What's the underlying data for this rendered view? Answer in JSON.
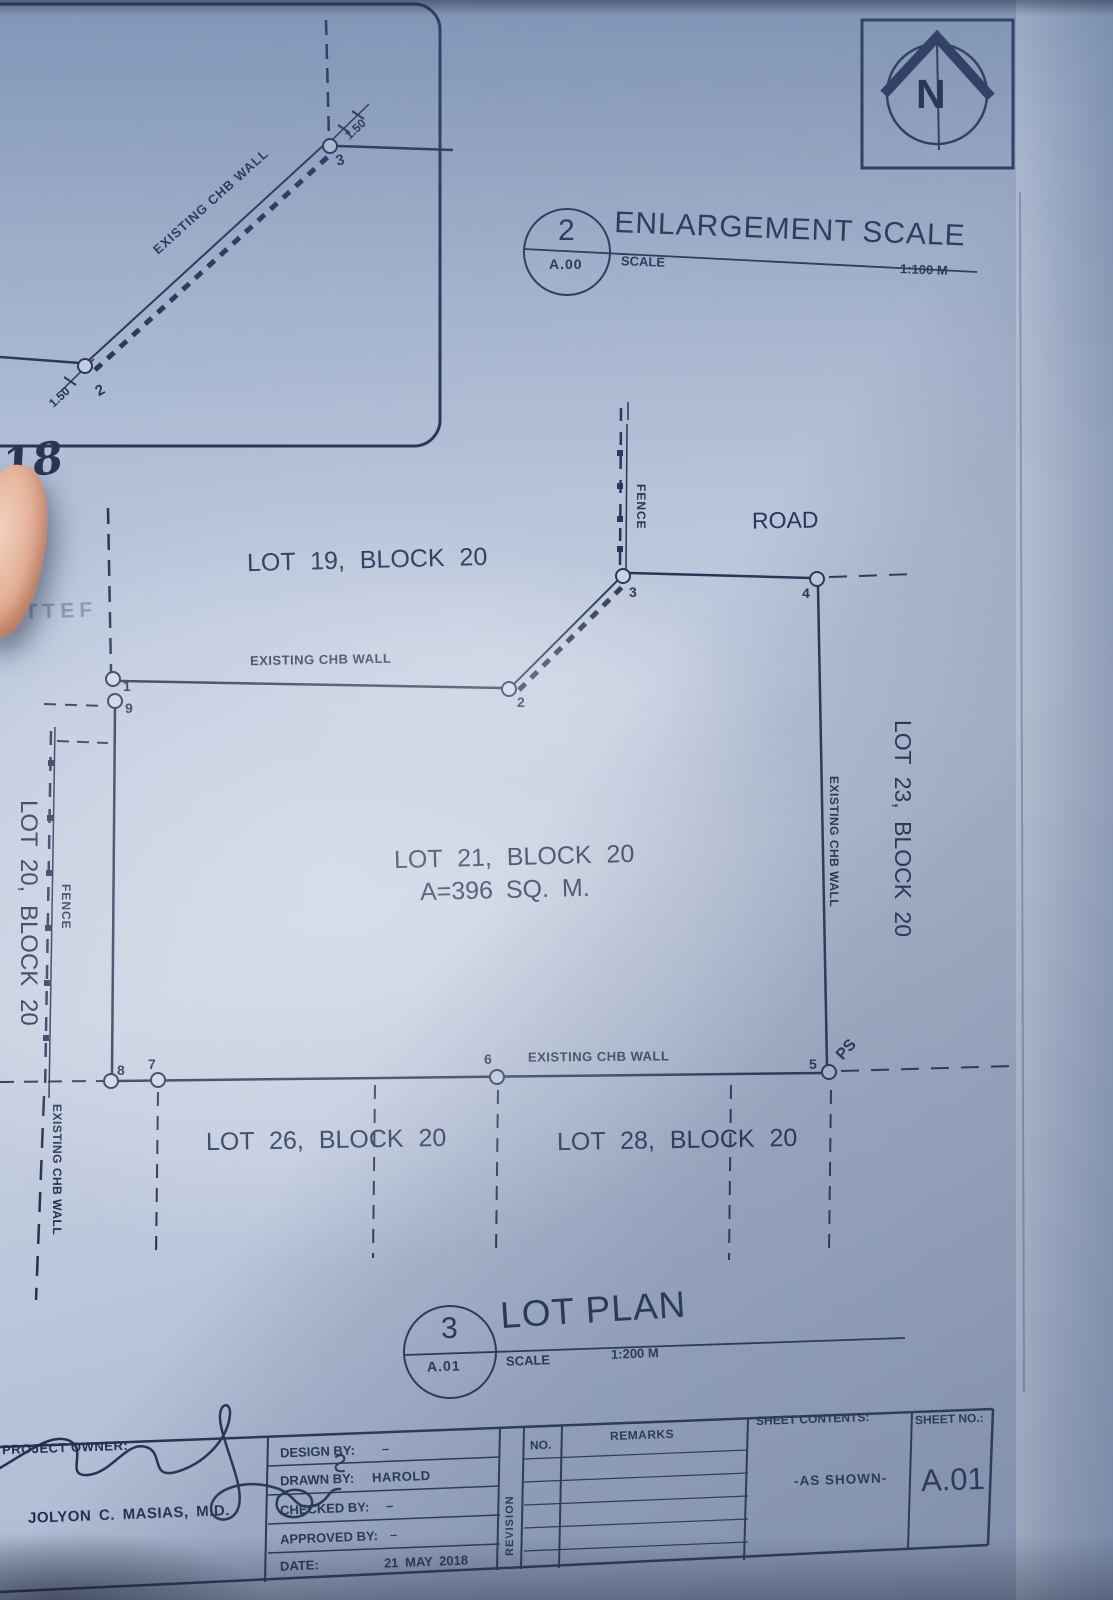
{
  "colors": {
    "paper": "#b7c3d8",
    "ink": "#243253"
  },
  "north_arrow": {
    "letter": "N"
  },
  "enlargement_view": {
    "bubble_number": "2",
    "bubble_sheet": "A.00",
    "title": "ENLARGEMENT SCALE",
    "scale_label": "SCALE",
    "scale_value": "1:100 M",
    "wall_label": "EXISTING CHB WALL",
    "dim_top": "1.50",
    "dim_bottom": "1.50",
    "point_top": "3",
    "point_bottom": "2"
  },
  "annotations": {
    "handwritten_number": "18",
    "faint_stamp": "ATTEF"
  },
  "plan": {
    "road_label": "ROAD",
    "fence_top": "FENCE",
    "fence_left": "FENCE",
    "wall_top": "EXISTING CHB WALL",
    "wall_right": "EXISTING CHB WALL",
    "wall_bottom": "EXISTING CHB WALL",
    "wall_left": "EXISTING CHB WALL",
    "ps_label": "PS",
    "lot19": "LOT 19, BLOCK 20",
    "lot20": "LOT 20, BLOCK 20",
    "lot21_name": "LOT 21, BLOCK 20",
    "lot21_area": "A=396 SQ. M.",
    "lot23": "LOT 23, BLOCK 20",
    "lot26": "LOT 26, BLOCK 20",
    "lot28": "LOT 28, BLOCK 20",
    "points": {
      "p1": "1",
      "p2": "2",
      "p3": "3",
      "p4": "4",
      "p5": "5",
      "p6": "6",
      "p7": "7",
      "p8": "8",
      "p9": "9"
    }
  },
  "lot_plan_view": {
    "bubble_number": "3",
    "bubble_sheet": "A.01",
    "title": "LOT PLAN",
    "scale_label": "SCALE",
    "scale_value": "1:200 M"
  },
  "title_block": {
    "project_owner_label": "PROJECT OWNER:",
    "project_owner_name": "JOLYON C. MASIAS, M.D.",
    "rows": [
      {
        "label": "DESIGN BY:",
        "value": "–"
      },
      {
        "label": "DRAWN BY:",
        "value": "HAROLD"
      },
      {
        "label": "CHECKED BY:",
        "value": "–"
      },
      {
        "label": "APPROVED BY:",
        "value": "–"
      },
      {
        "label": "DATE:",
        "value": "21 MAY 2018"
      }
    ],
    "revision_label": "REVISION",
    "no_label": "NO.",
    "remarks_label": "REMARKS",
    "sheet_contents_label": "SHEET CONTENTS:",
    "sheet_contents_value": "-AS SHOWN-",
    "sheet_no_label": "SHEET NO.:",
    "sheet_no_value": "A.01"
  }
}
